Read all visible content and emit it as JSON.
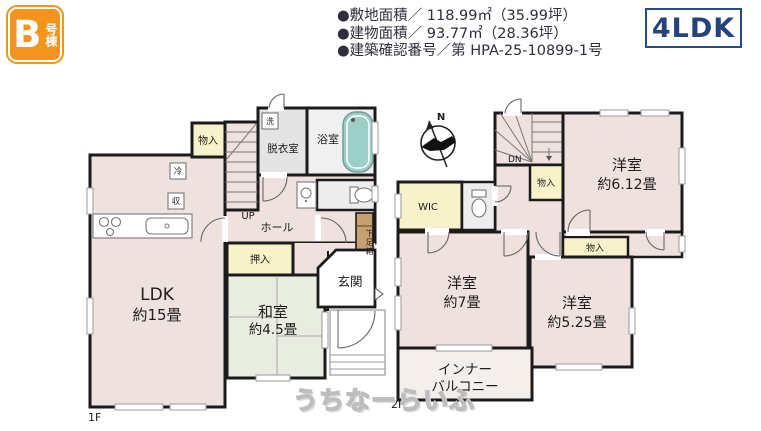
{
  "header": {
    "badge_letter": "B",
    "badge_suffix": "号棟",
    "spec_lines": [
      "●敷地面積／ 118.99㎡（35.99坪）",
      "●建物面積／ 93.77㎡（28.36坪）",
      "●建築確認番号／第 HPA-25-10899-1号"
    ],
    "layout_badge": "4LDK"
  },
  "floor1": {
    "label": "1F",
    "rooms": {
      "ldk": {
        "name": "LDK",
        "size": "約15畳"
      },
      "washitsu": {
        "name": "和室",
        "size": "約4.5畳"
      },
      "closet_top": "物入",
      "oshiire": "押入",
      "dressing": "脱衣室",
      "bath": "浴室",
      "hall": "ホール",
      "entrance": "玄関",
      "shoe_box": "下足箱",
      "fridge": "冷",
      "storage": "収",
      "washer": "洗",
      "stairs_up": "UP"
    }
  },
  "floor2": {
    "label": "2F",
    "rooms": {
      "west1": {
        "name": "洋室",
        "size": "約6.12畳"
      },
      "west2": {
        "name": "洋室",
        "size": "約7畳"
      },
      "west3": {
        "name": "洋室",
        "size": "約5.25畳"
      },
      "wic": "WIC",
      "closet_a": "物入",
      "closet_b": "物入",
      "balcony_line1": "インナー",
      "balcony_line2": "バルコニー",
      "stairs_down": "DN",
      "north_mark": "N"
    }
  },
  "watermark": "うちなーらいふ",
  "colors": {
    "accent_orange": "#F2951D",
    "badge_navy": "#24447E",
    "room_pink": "#EFE2DE",
    "tatami_green": "#E9ECE0",
    "closet_yellow": "#F7F2C9",
    "wet_gray": "#E4E4E4",
    "tub_teal": "#9CCFC8",
    "shoe_box_tan": "#C7A06F"
  }
}
